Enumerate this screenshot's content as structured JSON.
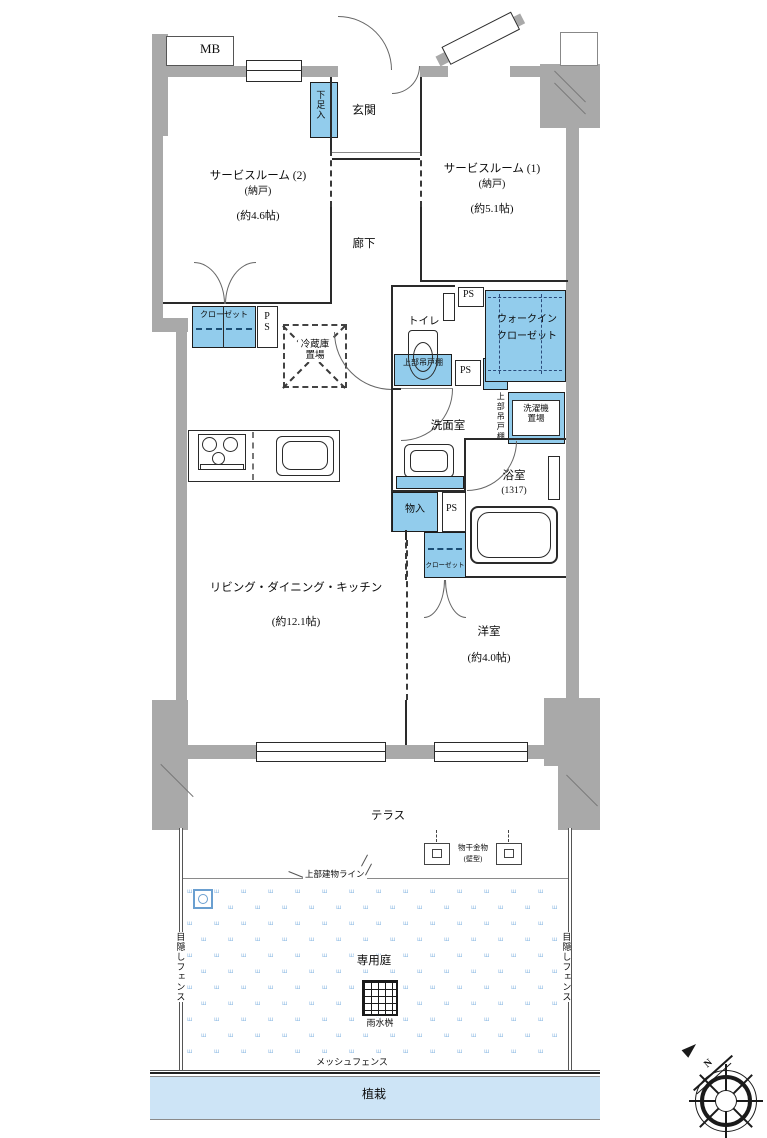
{
  "labels": {
    "mb": "MB",
    "shoe_box": "下足入",
    "entrance": "玄関",
    "service2_name": "サービスルーム (2)",
    "service2_sub": "(納戸)",
    "service2_size": "(約4.6帖)",
    "service1_name": "サービスルーム (1)",
    "service1_sub": "(納戸)",
    "service1_size": "(約5.1帖)",
    "corridor": "廊下",
    "closet": "クローゼット",
    "ps": "PS",
    "fridge_space": "冷蔵庫置場",
    "toilet": "トイレ",
    "wic_line1": "ウォークイン",
    "wic_line2": "クローゼット",
    "upper_cabinet": "上部吊戸棚",
    "linen": "リネン庫",
    "washroom": "洗面室",
    "laundry_space": "洗濯機置場",
    "bath": "浴室",
    "bath_size": "(1317)",
    "storage": "物入",
    "ldk": "リビング・ダイニング・キッチン",
    "ldk_size": "(約12.1帖)",
    "western": "洋室",
    "western_size": "(約4.0帖)",
    "terrace": "テラス",
    "drying_fixture": "物干金物",
    "drying_fixture_sub": "(壁型)",
    "building_line": "上部建物ライン",
    "private_garden": "専用庭",
    "rain_basin": "雨水桝",
    "privacy_fence": "目隠しフェンス",
    "mesh_fence": "メッシュフェンス",
    "planting": "植栽",
    "north": "N"
  },
  "garden": {
    "mark": "ш"
  },
  "colors": {
    "wall": "#a9a9a9",
    "fixture_blue": "#92ccec",
    "planting_band": "#cde4f6",
    "garden_mark": "#8cb9e3"
  }
}
